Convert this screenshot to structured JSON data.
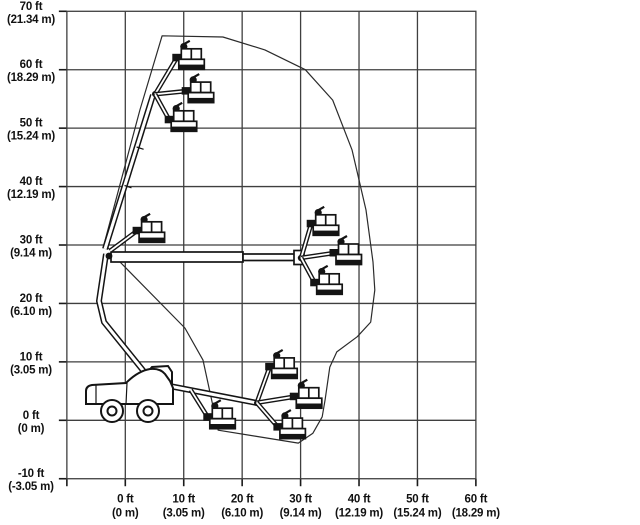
{
  "chart_data": {
    "type": "line",
    "description": "Articulating boom lift working-envelope (reach) diagram with machine shown in multiple boom and jib positions",
    "x_axis": {
      "range_ft": [
        -10,
        60
      ],
      "ticks": [
        {
          "value": 0,
          "label_ft": "0 ft",
          "label_m": "(0 m)"
        },
        {
          "value": 10,
          "label_ft": "10 ft",
          "label_m": "(3.05 m)"
        },
        {
          "value": 20,
          "label_ft": "20 ft",
          "label_m": "(6.10 m)"
        },
        {
          "value": 30,
          "label_ft": "30 ft",
          "label_m": "(9.14 m)"
        },
        {
          "value": 40,
          "label_ft": "40 ft",
          "label_m": "(12.19 m)"
        },
        {
          "value": 50,
          "label_ft": "50 ft",
          "label_m": "(15.24 m)"
        },
        {
          "value": 60,
          "label_ft": "60 ft",
          "label_m": "(18.29 m)"
        }
      ]
    },
    "y_axis": {
      "range_ft": [
        -10,
        70
      ],
      "ticks": [
        {
          "value": 70,
          "label_ft": "70 ft",
          "label_m": "(21.34 m)"
        },
        {
          "value": 60,
          "label_ft": "60 ft",
          "label_m": "(18.29 m)"
        },
        {
          "value": 50,
          "label_ft": "50 ft",
          "label_m": "(15.24 m)"
        },
        {
          "value": 40,
          "label_ft": "40 ft",
          "label_m": "(12.19 m)"
        },
        {
          "value": 30,
          "label_ft": "30 ft",
          "label_m": "(9.14 m)"
        },
        {
          "value": 20,
          "label_ft": "20 ft",
          "label_m": "(6.10 m)"
        },
        {
          "value": 10,
          "label_ft": "10 ft",
          "label_m": "(3.05 m)"
        },
        {
          "value": 0,
          "label_ft": "0 ft",
          "label_m": "(0 m)"
        },
        {
          "value": -10,
          "label_ft": "-10 ft",
          "label_m": "(-3.05 m)"
        }
      ]
    },
    "envelope_ft": [
      [
        6.3,
        65.8
      ],
      [
        16.7,
        65.6
      ],
      [
        23.9,
        63.4
      ],
      [
        30.8,
        60.0
      ],
      [
        35.5,
        54.8
      ],
      [
        38.8,
        46.3
      ],
      [
        41.2,
        36.0
      ],
      [
        42.4,
        27.1
      ],
      [
        42.7,
        22.3
      ],
      [
        42.0,
        16.8
      ],
      [
        39.7,
        14.3
      ],
      [
        36.2,
        11.7
      ],
      [
        35.0,
        9.1
      ],
      [
        34.2,
        3.5
      ],
      [
        33.7,
        0.6
      ],
      [
        32.1,
        -2.2
      ],
      [
        29.6,
        -3.9
      ],
      [
        22.2,
        -2.7
      ],
      [
        15.9,
        -1.7
      ],
      [
        13.3,
        10.3
      ],
      [
        10.2,
        15.8
      ],
      [
        -0.9,
        27.1
      ],
      [
        -3.6,
        30.3
      ],
      [
        2.5,
        53.1
      ]
    ],
    "platform_configs": [
      {
        "name": "boom-raised-tip",
        "hub_ft": [
          5.1,
          55.8
        ],
        "baskets_ft": [
          [
            9.5,
            64.6
          ],
          [
            11.1,
            58.9
          ],
          [
            8.2,
            54.0
          ]
        ]
      },
      {
        "name": "riser-top",
        "hub_ft": [
          -2.6,
          29.0
        ],
        "baskets_ft": [
          [
            2.7,
            35.0
          ]
        ]
      },
      {
        "name": "boom-horizontal-tip",
        "hub_ft": [
          30.1,
          27.8
        ],
        "baskets_ft": [
          [
            32.5,
            36.2
          ],
          [
            36.4,
            31.2
          ],
          [
            33.1,
            26.1
          ]
        ]
      },
      {
        "name": "boom-lowered-mid",
        "hub_ft": [
          11.2,
          5.2
        ],
        "baskets_ft": [
          [
            14.8,
            3.1
          ]
        ]
      },
      {
        "name": "boom-lowered-tip",
        "hub_ft": [
          22.5,
          3.0
        ],
        "baskets_ft": [
          [
            25.4,
            11.7
          ],
          [
            29.6,
            6.6
          ],
          [
            26.8,
            1.4
          ]
        ]
      }
    ],
    "grid": "on",
    "colors": {
      "grid": "#3f3f3f",
      "line_art": "#141414",
      "background": "#ffffff"
    }
  }
}
